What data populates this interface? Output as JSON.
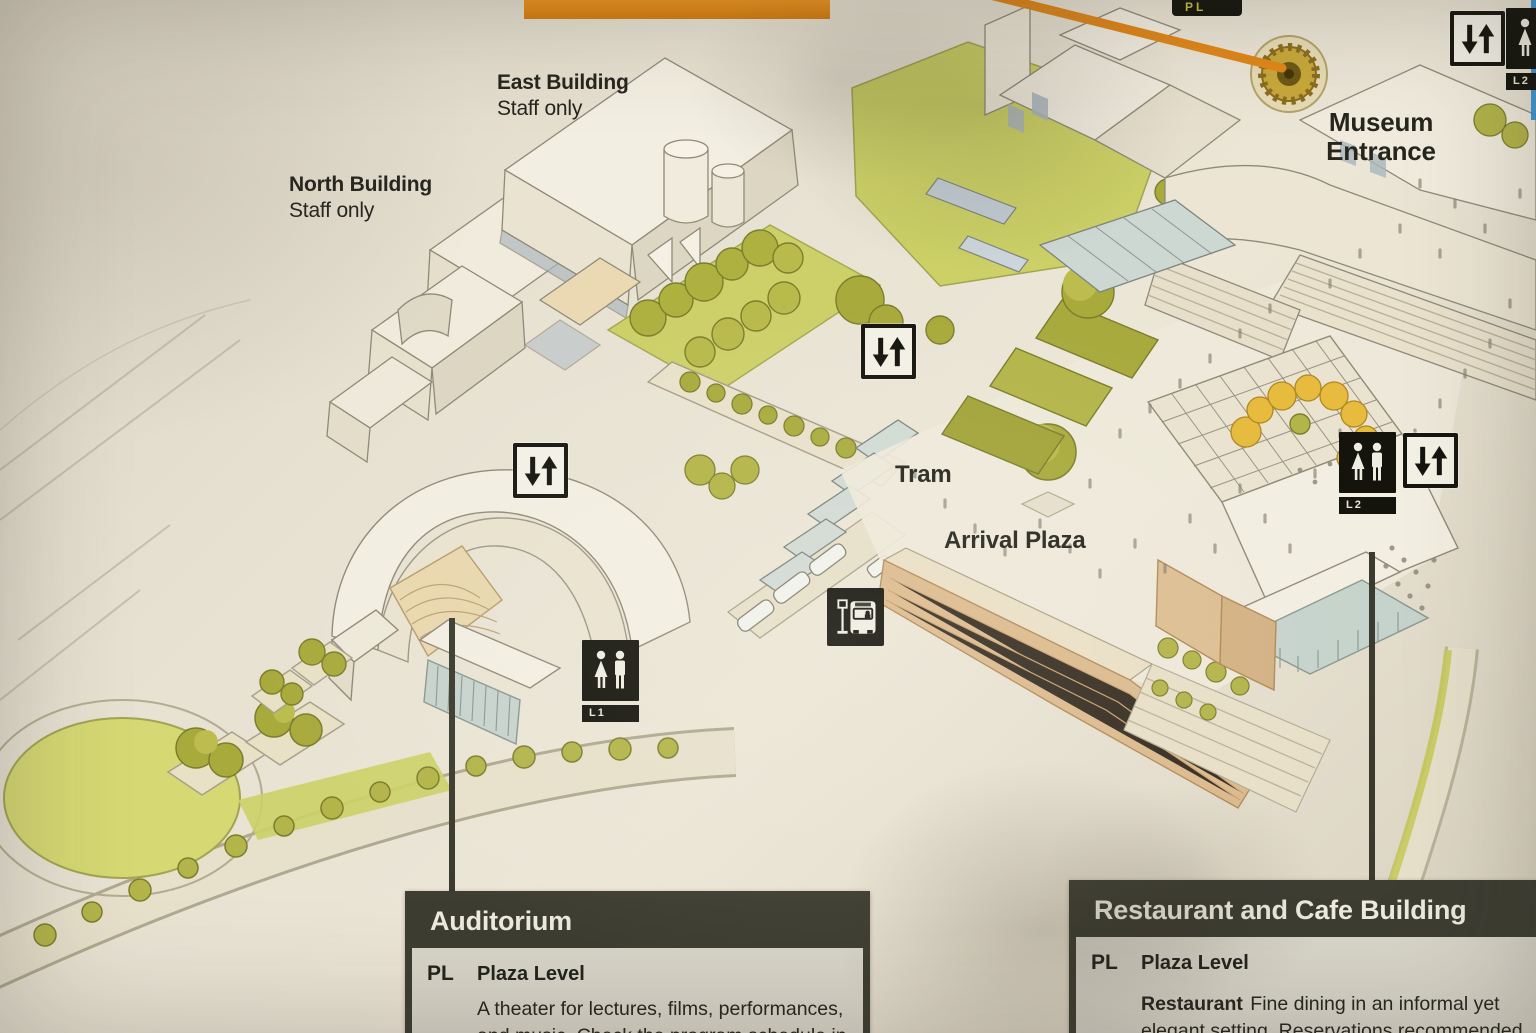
{
  "route_tag": {
    "text": "PL"
  },
  "labels": {
    "east_building": {
      "name": "East Building",
      "note": "Staff only"
    },
    "north_building": {
      "name": "North Building",
      "note": "Staff only"
    },
    "museum_entrance_line1": "Museum",
    "museum_entrance_line2": "Entrance",
    "tram": "Tram",
    "arrival_plaza": "Arrival Plaza"
  },
  "icons": {
    "restroom_auditorium_level": "L1",
    "restroom_restaurant_level": "L2",
    "restroom_museum_level": "L2"
  },
  "info_boxes": {
    "auditorium": {
      "title": "Auditorium",
      "level_code": "PL",
      "level_name": "Plaza Level",
      "desc_line1": "A theater for lectures, films, performances,",
      "desc_line2": "and music. Check the program schedule in"
    },
    "restaurant": {
      "title": "Restaurant and Cafe Building",
      "level_code": "PL",
      "level_name": "Plaza Level",
      "item": "Restaurant",
      "desc_line1": "Fine dining in an informal yet",
      "desc_line2": "elegant setting. Reservations recommended."
    }
  },
  "colors": {
    "accent_orange": "#e0871a",
    "box_header": "#3d3d32",
    "box_body": "#d8d5c9",
    "lawn_green": "#ccd066",
    "tree_olive": "#a9aa3c",
    "tree_yellow": "#e6bb3e",
    "paper": "#e7e1d2"
  }
}
